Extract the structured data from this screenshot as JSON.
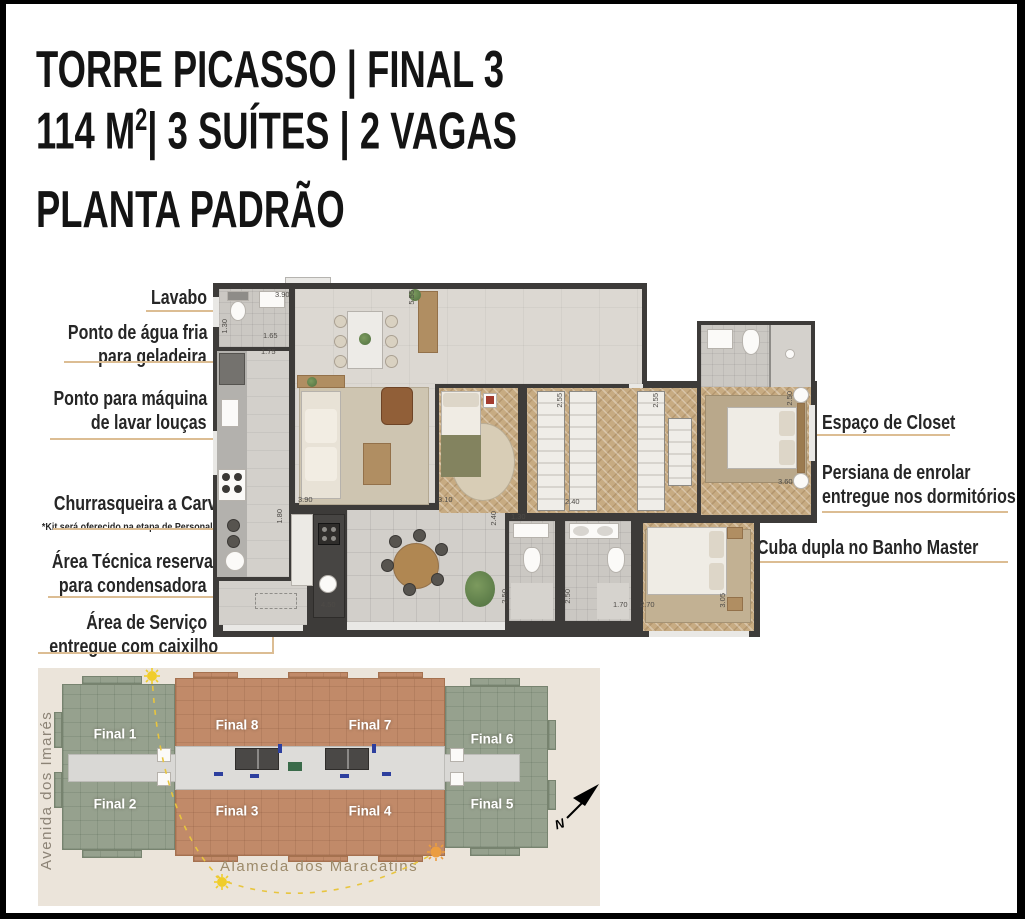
{
  "title": {
    "line1": "TORRE PICASSO | FINAL 3",
    "line2_pre": "114 M",
    "line2_sup": "2",
    "line2_post": "| 3 SUÍTES | 2 VAGAS",
    "line3": "PLANTA PADRÃO"
  },
  "callouts_left": [
    {
      "lines": [
        "Lavabo"
      ]
    },
    {
      "lines": [
        "Ponto de água fria",
        "para geladeira"
      ]
    },
    {
      "lines": [
        "Ponto para máquina",
        "de lavar louças"
      ]
    },
    {
      "lines": [
        "Churrasqueira a Carvão*"
      ],
      "note": "*Kit será oferecido na etapa de Personal Home"
    },
    {
      "lines": [
        "Área Técnica reservada",
        "para condensadora"
      ]
    },
    {
      "lines": [
        "Área de Serviço",
        "entregue com caixilho"
      ]
    }
  ],
  "callouts_right": [
    {
      "lines": [
        "Espaço de Closet"
      ]
    },
    {
      "lines": [
        "Persiana de enrolar",
        "entregue nos dormitórios"
      ]
    },
    {
      "lines": [
        "Cuba dupla no Banho Master"
      ]
    }
  ],
  "plan": {
    "dimensions": [
      "3.90",
      "1.30",
      "1.65",
      "1.75",
      "5.55",
      "2.55",
      "2.55",
      "2.50",
      "3.60",
      "3.90",
      "3.10",
      "2.40",
      "1.30",
      "2.40",
      "1.80",
      "2.50",
      "2.50",
      "1.70",
      "2.70",
      "3.05",
      "4.50"
    ]
  },
  "site_plan": {
    "units": [
      {
        "label": "Final 1"
      },
      {
        "label": "Final 2"
      },
      {
        "label": "Final 8"
      },
      {
        "label": "Final 3"
      },
      {
        "label": "Final 7"
      },
      {
        "label": "Final 4"
      },
      {
        "label": "Final 6"
      },
      {
        "label": "Final 5"
      }
    ],
    "streets": {
      "left": "Avenida dos Imarés",
      "bottom": "Alameda dos Maracatins"
    },
    "north_label": "N",
    "icons": {
      "sun": "sun-icon",
      "north": "north-arrow-icon"
    },
    "colors": {
      "green": "#96A18E",
      "terracotta": "#C18A69",
      "background": "#EBE4DA",
      "sun_path": "#E8C53E"
    }
  },
  "colors": {
    "leader_line": "#DCBD93",
    "wall": "#3D3B39",
    "title_text": "#141414"
  }
}
